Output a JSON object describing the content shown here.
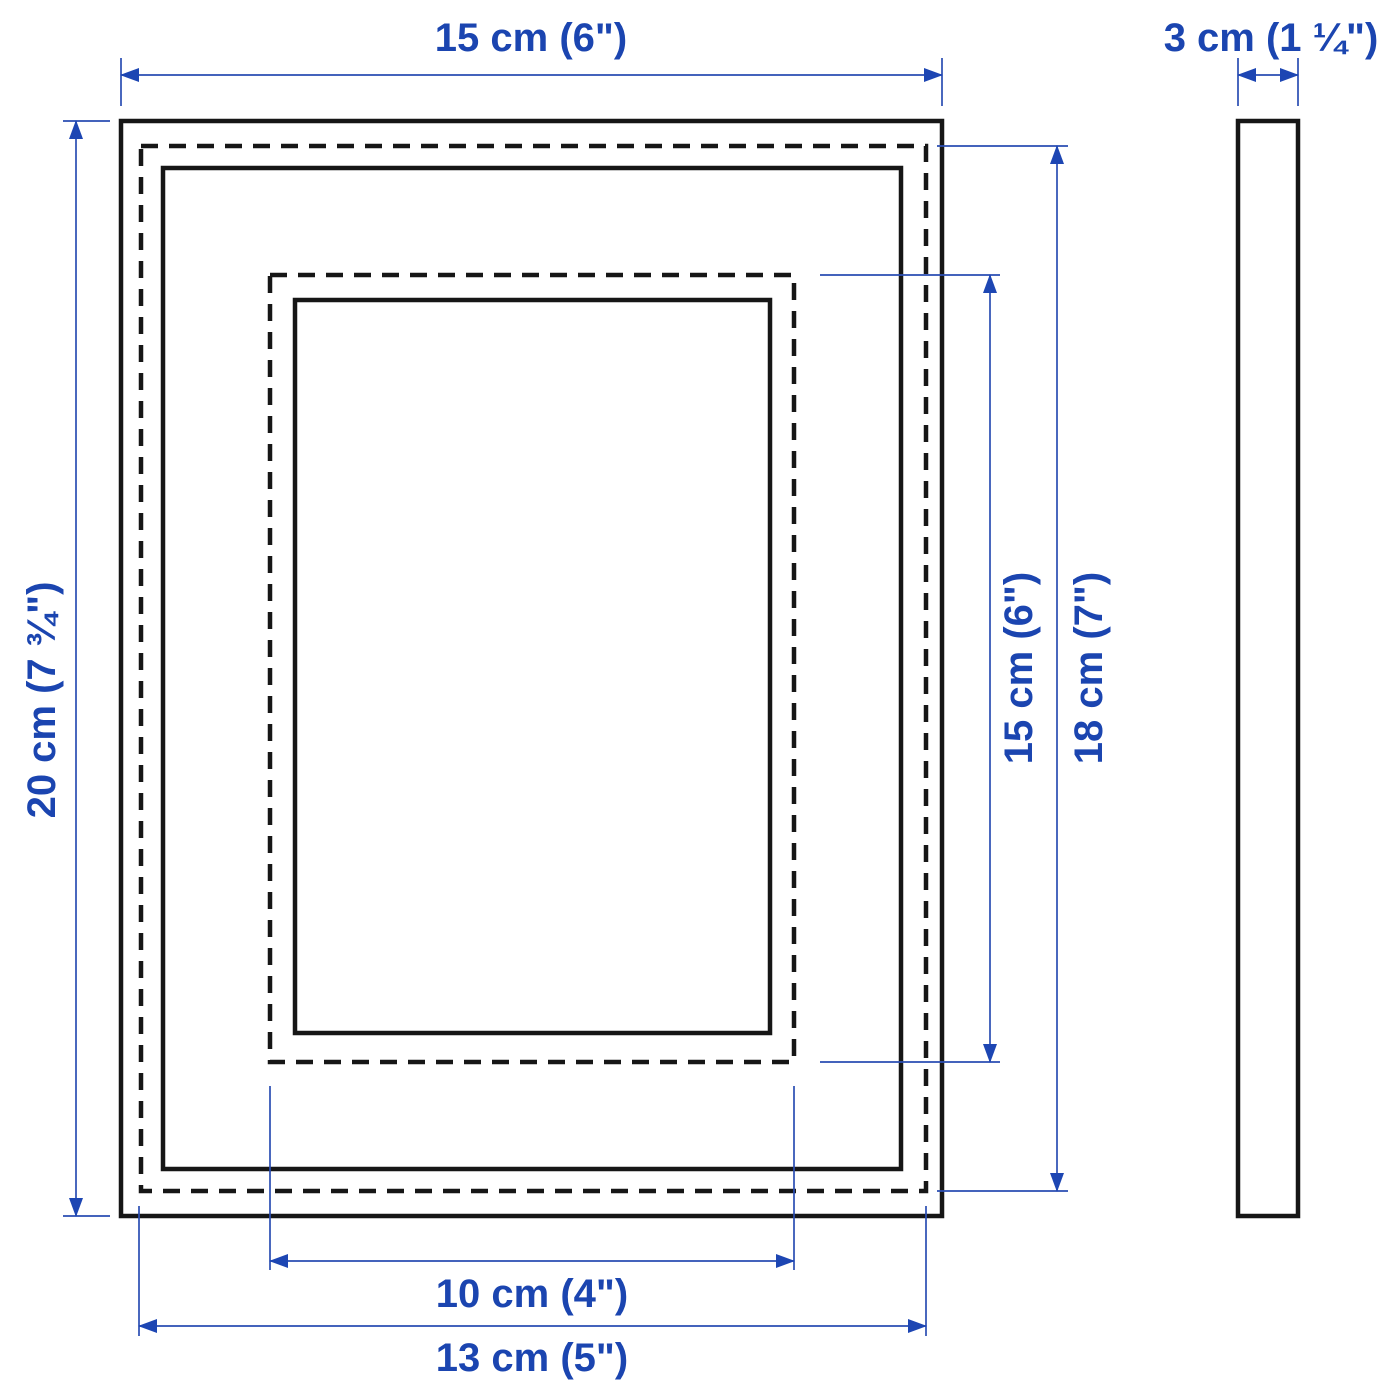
{
  "diagram_title": "Picture frame dimension drawing",
  "colors": {
    "dimension_blue": "#1b45b0",
    "outline_black": "#161616",
    "background": "#ffffff"
  },
  "icons": {
    "dimension-arrowhead": "filled triangle at both ends of each blue dimension line"
  },
  "dimensions": {
    "frame_width": "15 cm (6\")",
    "frame_depth": "3 cm (1 ¼\")",
    "frame_height": "20 cm (7 ¾\")",
    "picture_with_mat_height": "15 cm (6\")",
    "picture_height": "18 cm (7\")",
    "picture_with_mat_width": "10 cm (4\")",
    "picture_width": "13 cm (5\")"
  }
}
